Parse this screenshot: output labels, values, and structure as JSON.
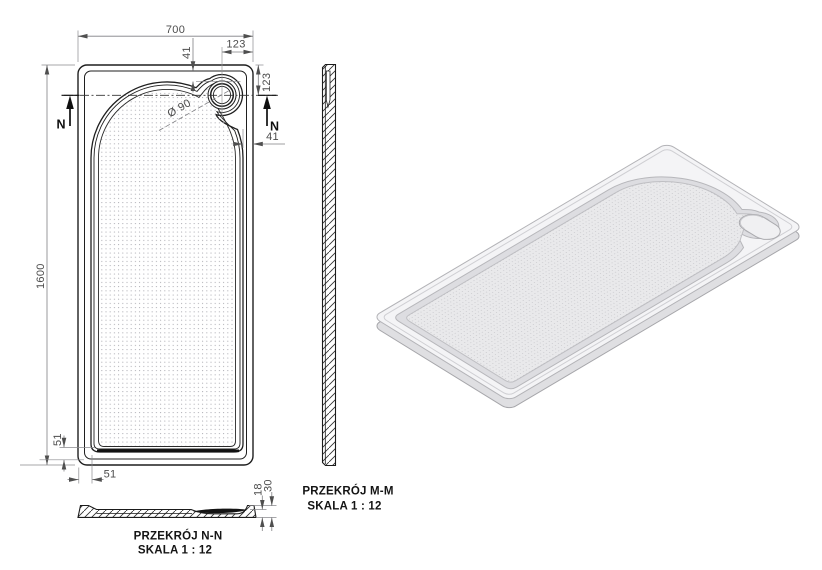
{
  "dims": {
    "width": "700",
    "length": "1600",
    "drain_offset_top": "123",
    "drain_offset_right": "123",
    "gap_top": "41",
    "gap_right": "41",
    "margin_left": "51",
    "margin_bottom": "51",
    "drain_diameter": "Ø 90"
  },
  "marks": {
    "section_letter": "N"
  },
  "sections": {
    "mm": {
      "title": "PRZEKRÓJ M-M",
      "scale": "SKALA 1 : 12"
    },
    "nn": {
      "title": "PRZEKRÓJ N-N",
      "scale": "SKALA 1 : 12"
    },
    "thickness": {
      "floor": "18",
      "total": "30"
    }
  },
  "colors": {
    "line": "#1f1f1f",
    "dim_line": "#7f7f83",
    "iso_top": "#f4f4f6",
    "iso_band": "#dddde1",
    "iso_floor": "#e9e9eb",
    "iso_side": "#dfdfe2"
  }
}
